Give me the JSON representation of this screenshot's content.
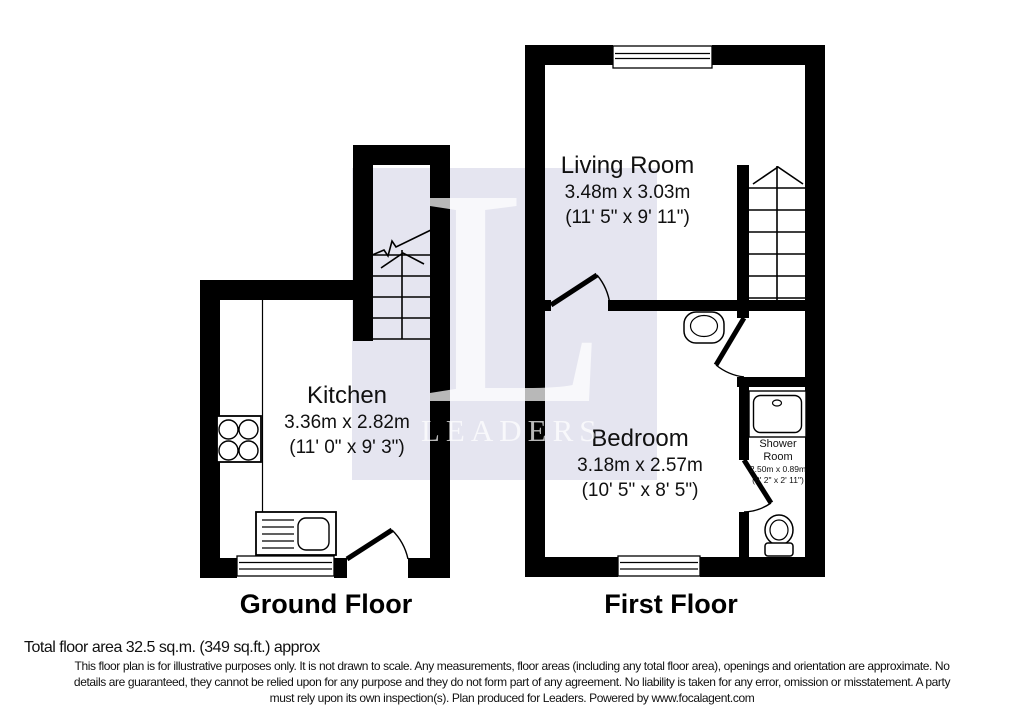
{
  "watermark": {
    "letter": "L",
    "brand": "LEADERS",
    "tint": "#e5e5f0"
  },
  "colors": {
    "wall": "#000000",
    "text": "#111111"
  },
  "ground_floor": {
    "label": "Ground Floor",
    "rooms": {
      "kitchen": {
        "name": "Kitchen",
        "metric": "3.36m x 2.82m",
        "imperial": "(11' 0\" x 9' 3\")"
      }
    }
  },
  "first_floor": {
    "label": "First Floor",
    "rooms": {
      "living_room": {
        "name": "Living Room",
        "metric": "3.48m x 3.03m",
        "imperial": "(11' 5\" x 9' 11\")"
      },
      "bedroom": {
        "name": "Bedroom",
        "metric": "3.18m x 2.57m",
        "imperial": "(10' 5\" x 8' 5\")"
      },
      "shower_room": {
        "name_line1": "Shower",
        "name_line2": "Room",
        "metric": "2.50m x 0.89m",
        "imperial": "(8' 2\" x 2' 11\")"
      }
    }
  },
  "footer": {
    "total_area": "Total floor area 32.5 sq.m. (349 sq.ft.) approx",
    "disclaimer": [
      "This floor plan is for illustrative purposes only. It is not drawn to scale. Any measurements, floor areas (including any total floor area), openings and orientation are approximate. No",
      "details are guaranteed, they cannot be relied upon for any purpose and they do not form part of any agreement. No liability is taken for any error, omission or misstatement. A party",
      "must rely upon its own inspection(s). Plan produced for Leaders. Powered by www.focalagent.com"
    ]
  }
}
